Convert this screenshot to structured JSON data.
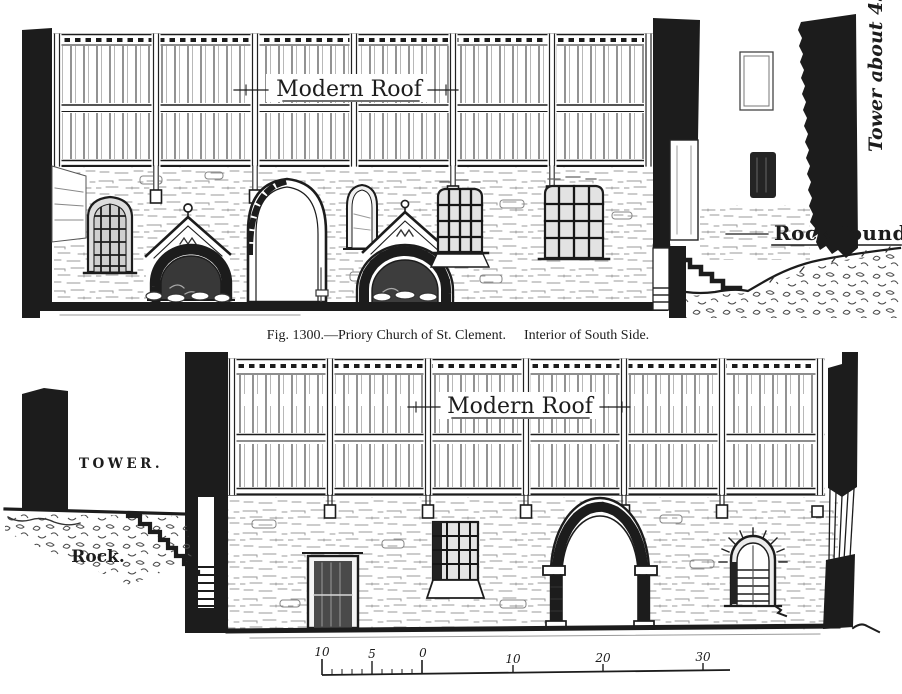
{
  "colors": {
    "paper": "#ffffff",
    "ink": "#1c1c1c"
  },
  "caption": {
    "part1": "Fig. 1300.—Priory Church of St. Clement.",
    "part2": "Interior of South Side."
  },
  "upper_drawing": {
    "roof_label": "Modern Roof",
    "tower_note": "Tower about 45 f",
    "rock_note": "Rock foundati"
  },
  "lower_drawing": {
    "roof_label": "Modern Roof",
    "tower_label": "TOWER.",
    "rock_label": "Rock."
  },
  "scale_bar": {
    "ticks": [
      "10",
      "5",
      "0",
      "10",
      "20",
      "30"
    ]
  }
}
